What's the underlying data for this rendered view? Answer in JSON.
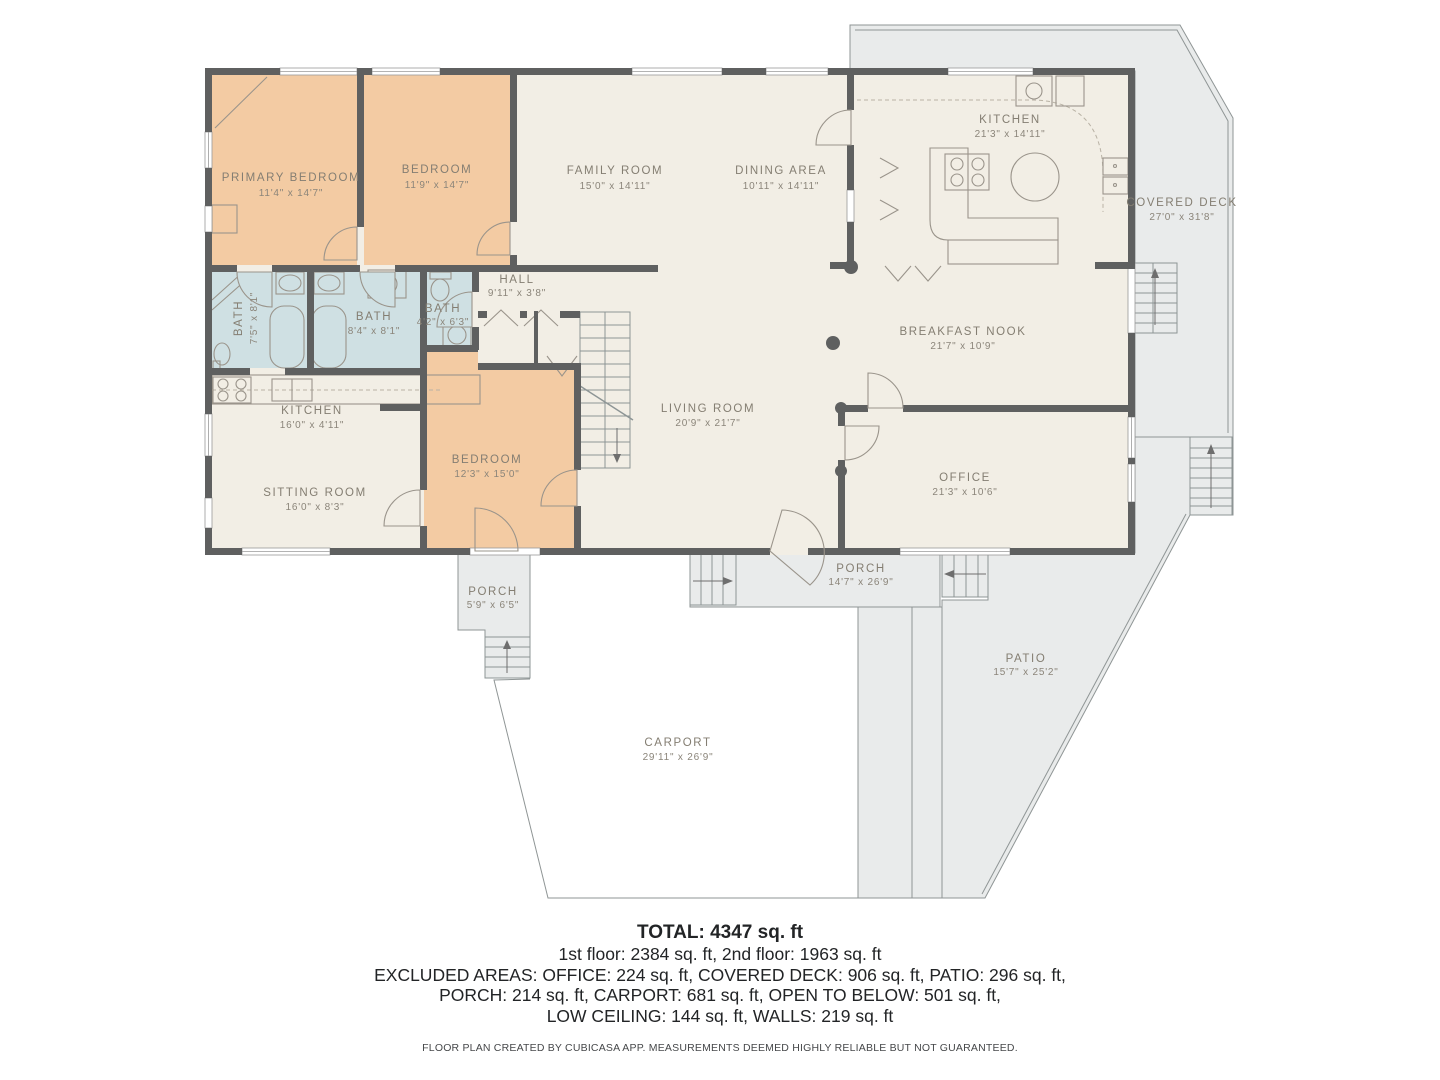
{
  "colors": {
    "bedroom_fill": "#f3cba3",
    "bath_fill": "#cfe0e3",
    "interior_fill": "#f2eee5",
    "outdoor_fill": "#e9ebeb",
    "wall": "#5f6060",
    "label_text": "#847e72"
  },
  "rooms": {
    "primary_bedroom": {
      "name": "PRIMARY BEDROOM",
      "dims": "11'4\" x 14'7\""
    },
    "bedroom2": {
      "name": "BEDROOM",
      "dims": "11'9\" x 14'7\""
    },
    "family_room": {
      "name": "FAMILY ROOM",
      "dims": "15'0\" x 14'11\""
    },
    "dining_area": {
      "name": "DINING AREA",
      "dims": "10'11\" x 14'11\""
    },
    "kitchen_main": {
      "name": "KITCHEN",
      "dims": "21'3\" x 14'11\""
    },
    "covered_deck": {
      "name": "COVERED DECK",
      "dims": "27'0\" x 31'8\""
    },
    "hall": {
      "name": "HALL",
      "dims": "9'11\" x 3'8\""
    },
    "bath1": {
      "name": "BATH",
      "dims": "7'5\" x 8'1\""
    },
    "bath2": {
      "name": "BATH",
      "dims": "8'4\" x 8'1\""
    },
    "bath3": {
      "name": "BATH",
      "dims": "4'2\" x 6'3\""
    },
    "breakfast_nook": {
      "name": "BREAKFAST NOOK",
      "dims": "21'7\" x 10'9\""
    },
    "living_room": {
      "name": "LIVING ROOM",
      "dims": "20'9\" x 21'7\""
    },
    "office": {
      "name": "OFFICE",
      "dims": "21'3\" x 10'6\""
    },
    "kitchen_small": {
      "name": "KITCHEN",
      "dims": "16'0\" x 4'11\""
    },
    "sitting_room": {
      "name": "SITTING ROOM",
      "dims": "16'0\" x 8'3\""
    },
    "bedroom3": {
      "name": "BEDROOM",
      "dims": "12'3\" x 15'0\""
    },
    "porch_left": {
      "name": "PORCH",
      "dims": "5'9\" x 6'5\""
    },
    "porch_center": {
      "name": "PORCH",
      "dims": "14'7\" x 26'9\""
    },
    "carport": {
      "name": "CARPORT",
      "dims": "29'11\" x 26'9\""
    },
    "patio": {
      "name": "PATIO",
      "dims": "15'7\" x 25'2\""
    }
  },
  "summary": {
    "total": "TOTAL: 4347 sq. ft",
    "floors": "1st floor: 2384 sq. ft, 2nd floor: 1963 sq. ft",
    "excluded_line1": "EXCLUDED AREAS: OFFICE: 224 sq. ft, COVERED DECK: 906 sq. ft, PATIO: 296 sq. ft,",
    "excluded_line2": "PORCH: 214 sq. ft, CARPORT: 681 sq. ft, OPEN TO BELOW: 501 sq. ft,",
    "excluded_line3": "LOW CEILING: 144 sq. ft, WALLS: 219 sq. ft",
    "disclaimer": "FLOOR PLAN CREATED BY CUBICASA APP. MEASUREMENTS DEEMED HIGHLY RELIABLE BUT NOT GUARANTEED."
  }
}
